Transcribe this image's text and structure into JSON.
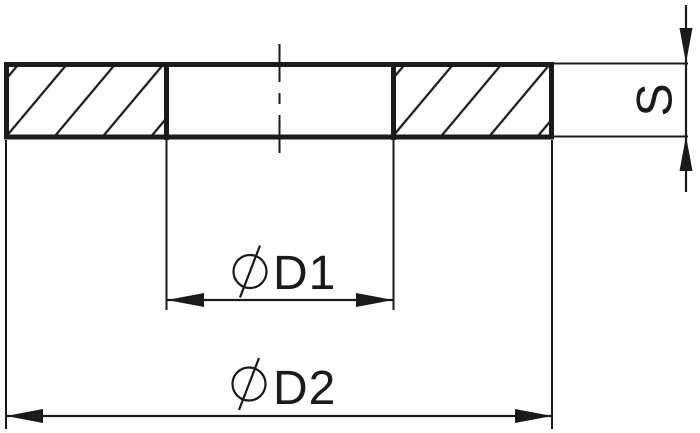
{
  "page": {
    "background": "#ffffff",
    "line_color": "#1a1a1a"
  },
  "dimensions": {
    "inner_diameter": {
      "symbol": "⌀",
      "label": "D1"
    },
    "outer_diameter": {
      "symbol": "⌀",
      "label": "D2"
    },
    "thickness": {
      "label": "S"
    }
  }
}
